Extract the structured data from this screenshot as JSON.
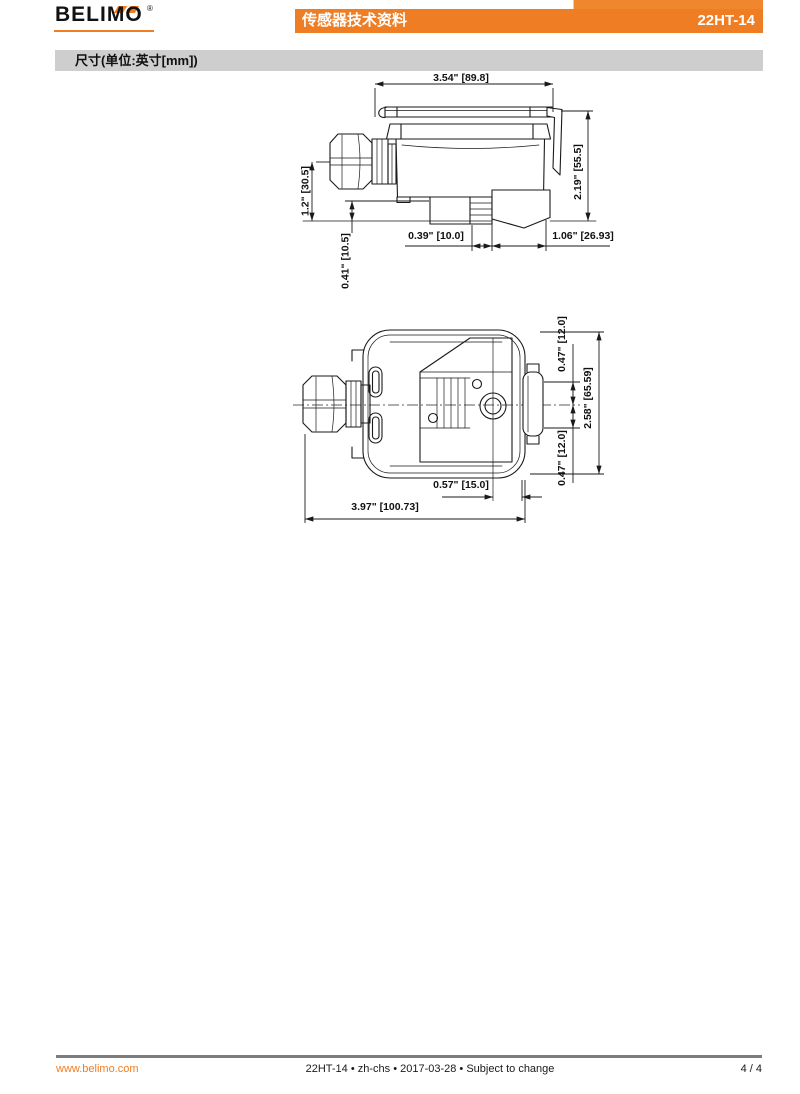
{
  "header": {
    "logo_text": "BELIMO",
    "registered_mark": "®",
    "bar_title": "传感器技术资料",
    "product_code": "22HT-14"
  },
  "section": {
    "title": "尺寸(单位:英寸[mm])"
  },
  "drawings": {
    "side_view": {
      "dims": {
        "width_top": "3.54\" [89.8]",
        "height_right": "2.19\" [55.5]",
        "gland_center_height": "1.2\" [30.5]",
        "step_height": "0.41\" [10.5]",
        "neck_width": "0.39\" [10.0]",
        "flange_width": "1.06\" [26.93]"
      }
    },
    "bottom_view": {
      "dims": {
        "offset_top": "0.47\" [12.0]",
        "overall_height": "2.58\" [65.59]",
        "offset_bottom": "0.47\" [12.0]",
        "hole_offset": "0.57\" [15.0]",
        "overall_width": "3.97\" [100.73]"
      }
    }
  },
  "footer": {
    "website": "www.belimo.com",
    "doc_info": "22HT-14 • zh-chs • 2017-03-28 • Subject to change",
    "page_number": "4 / 4"
  },
  "colors": {
    "accent": "#EF7D23",
    "section_bar": "#CECECE",
    "footer_rule": "#7D7D7D"
  }
}
